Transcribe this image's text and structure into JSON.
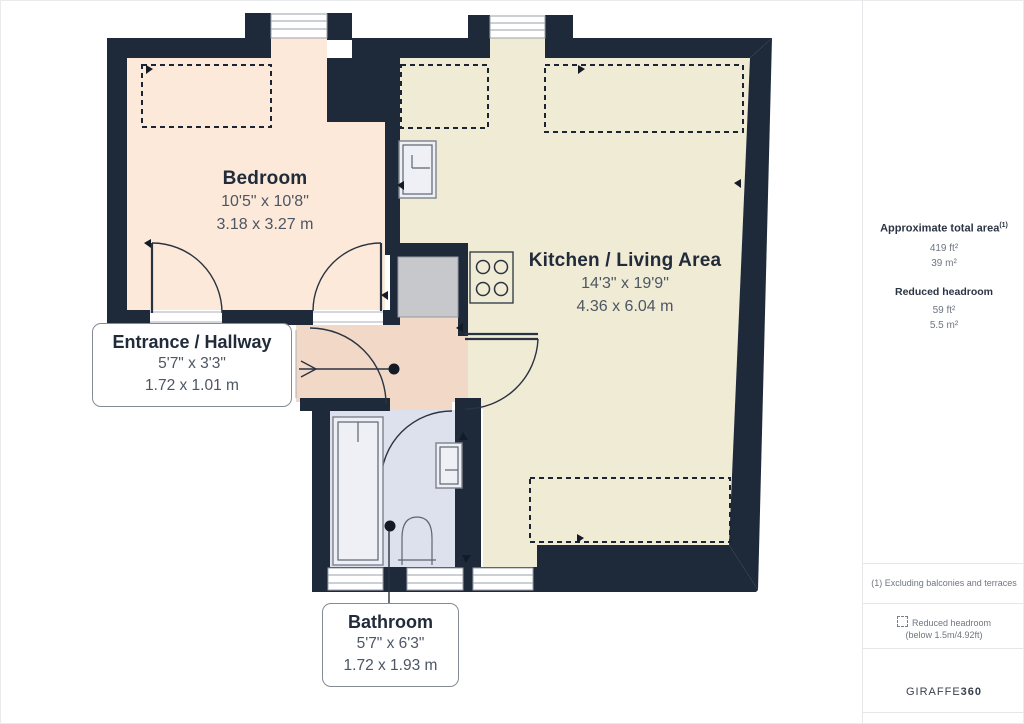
{
  "rooms": [
    {
      "name": "Bedroom",
      "dims_imperial": "10'5\" x 10'8\"",
      "dims_metric": "3.18 x 3.27 m"
    },
    {
      "name": "Kitchen / Living Area",
      "dims_imperial": "14'3\" x 19'9\"",
      "dims_metric": "4.36 x 6.04 m"
    },
    {
      "name": "Entrance / Hallway",
      "dims_imperial": "5'7\" x 3'3\"",
      "dims_metric": "1.72 x 1.01 m"
    },
    {
      "name": "Bathroom",
      "dims_imperial": "5'7\" x 6'3\"",
      "dims_metric": "1.72 x 1.93 m"
    }
  ],
  "sidebar": {
    "total_area_label": "Approximate total area",
    "total_area_superscript": "(1)",
    "total_area_ft": "419 ft²",
    "total_area_m": "39 m²",
    "reduced_headroom_label": "Reduced headroom",
    "reduced_headroom_ft": "59 ft²",
    "reduced_headroom_m": "5.5 m²",
    "footnote": "(1) Excluding balconies and terraces",
    "legend_reduced_line1": "Reduced headroom",
    "legend_reduced_line2": "(below 1.5m/4.92ft)",
    "brand_regular": "GIRAFFE",
    "brand_bold": "360"
  },
  "colors": {
    "wall": "#1e2a3a",
    "line": "#2a3342",
    "bedroom": "#fce9d9",
    "kitchen": "#f0ebd5",
    "hallway": "#f2d8c6",
    "bathroom": "#dde1ed"
  }
}
